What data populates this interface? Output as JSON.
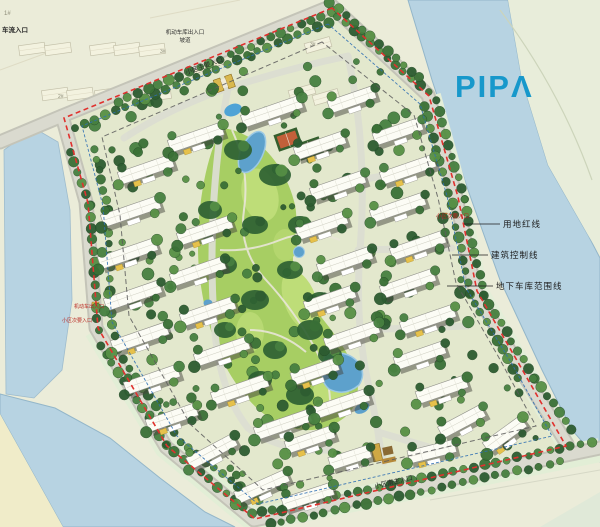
{
  "logo": {
    "display": "PIPΛ",
    "color": "#1798CB"
  },
  "callouts": {
    "site_red_line": "用地红线",
    "building_control_line": "建筑控制线",
    "garage_extent_line": "地下车库范围线"
  },
  "entrances": {
    "traffic_entry_topleft": "车流入口",
    "garage_ramp_line1": "机动车库出入口",
    "garage_ramp_line2": "坡道",
    "main_entry_top": "小区主要入口",
    "secondary_entry_right": "小区次要入口",
    "vehicle_entry_left": "机动车出入口",
    "secondary_entry_left": "小区次要入口",
    "south_entry": "小区南主入口"
  },
  "parcel_labels": {
    "p1": "1#",
    "p2": "2#",
    "p3": "3#",
    "p4": "3#"
  },
  "colors": {
    "red_line": "#E0312E",
    "control_line": "#2F6FB2",
    "garage_line": "#5C5C5C",
    "water": "#B7D3E2",
    "lawn": "#A7CE63",
    "road": "#D2D2C8",
    "logo_blue": "#1798CB"
  }
}
